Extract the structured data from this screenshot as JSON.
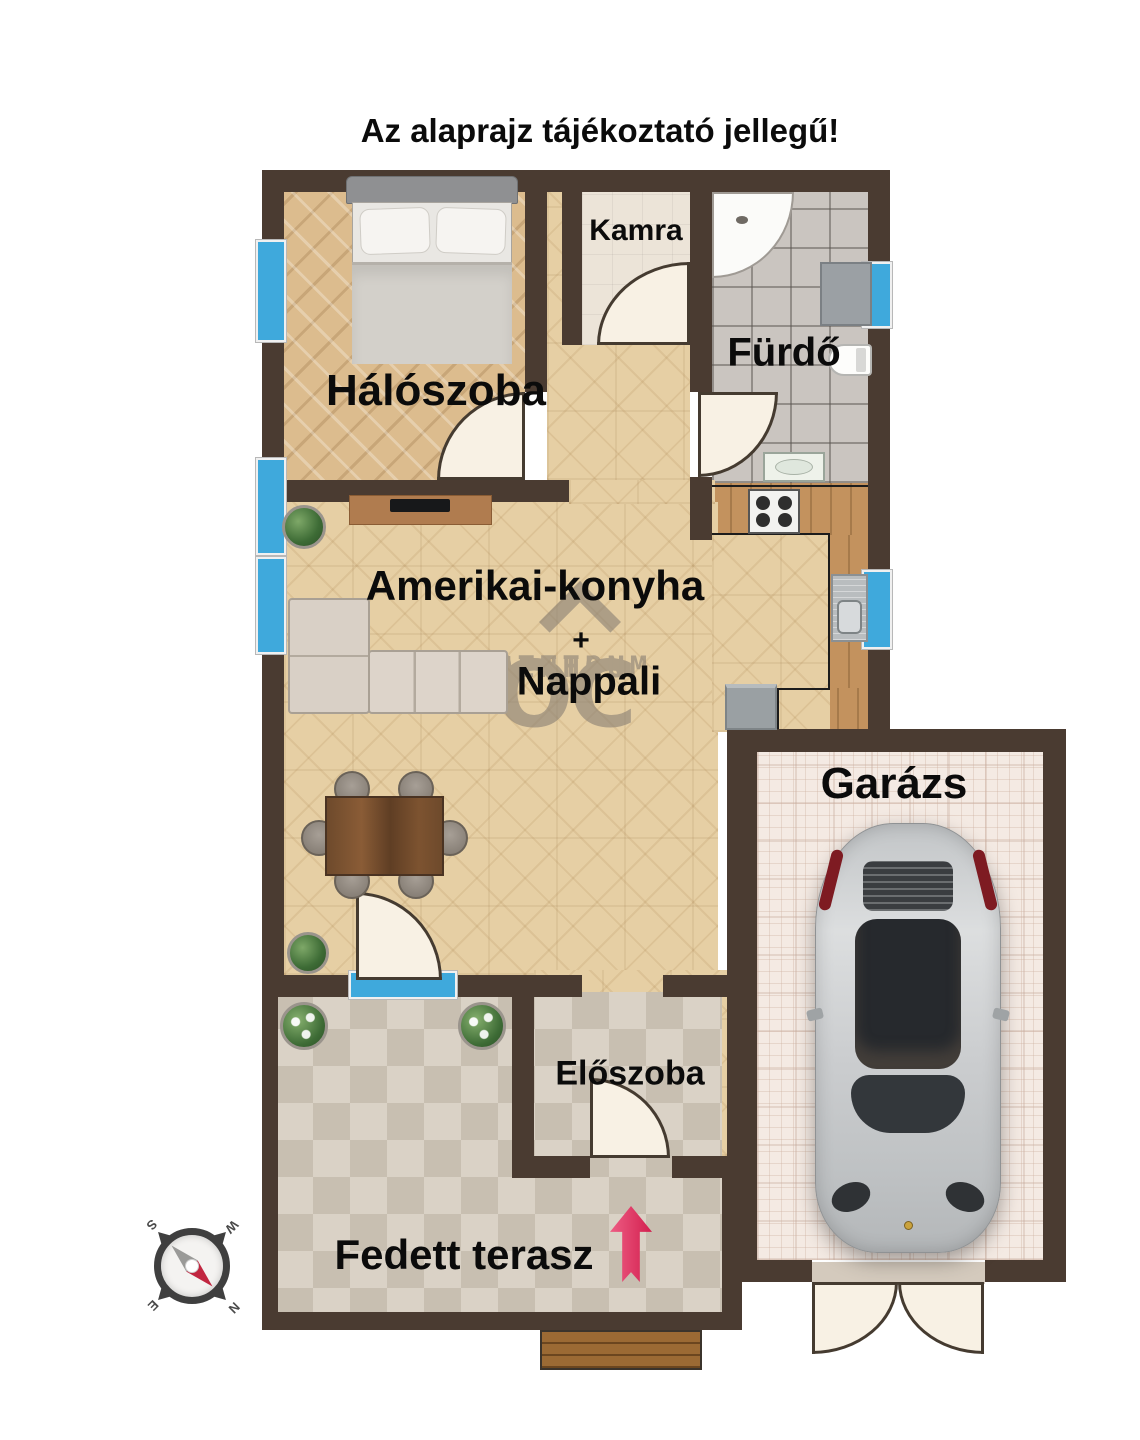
{
  "title": "Az alaprajz tájékoztató jellegű!",
  "rooms": {
    "bedroom": "Hálószoba",
    "pantry": "Kamra",
    "bathroom": "Fürdő",
    "living_line1": "Amerikai-konyha",
    "living_plus": "+",
    "living_line2": "Nappali",
    "hall": "Előszoba",
    "garage": "Garázs",
    "terrace": "Fedett terasz"
  },
  "watermark": {
    "monogram": "OC",
    "line1": "OTTHON",
    "line2": "CENTRUM"
  },
  "compass": {
    "north": "N",
    "south": "S",
    "east": "E",
    "west": "W"
  },
  "colors": {
    "wall": "#4a3b31",
    "window": "#3fa9dc",
    "door_leaf": "#f8f1e4",
    "parquet": "#e6cfa4",
    "bedroom_wood": "#dcbc8e",
    "bath_tile": "#cac5c0",
    "terrace_tile": "#d8d0c3",
    "garage_floor": "#f4eae3",
    "arrow": "#d84a6b",
    "label": "#0b0b0b",
    "watermark": "#8b8174"
  }
}
